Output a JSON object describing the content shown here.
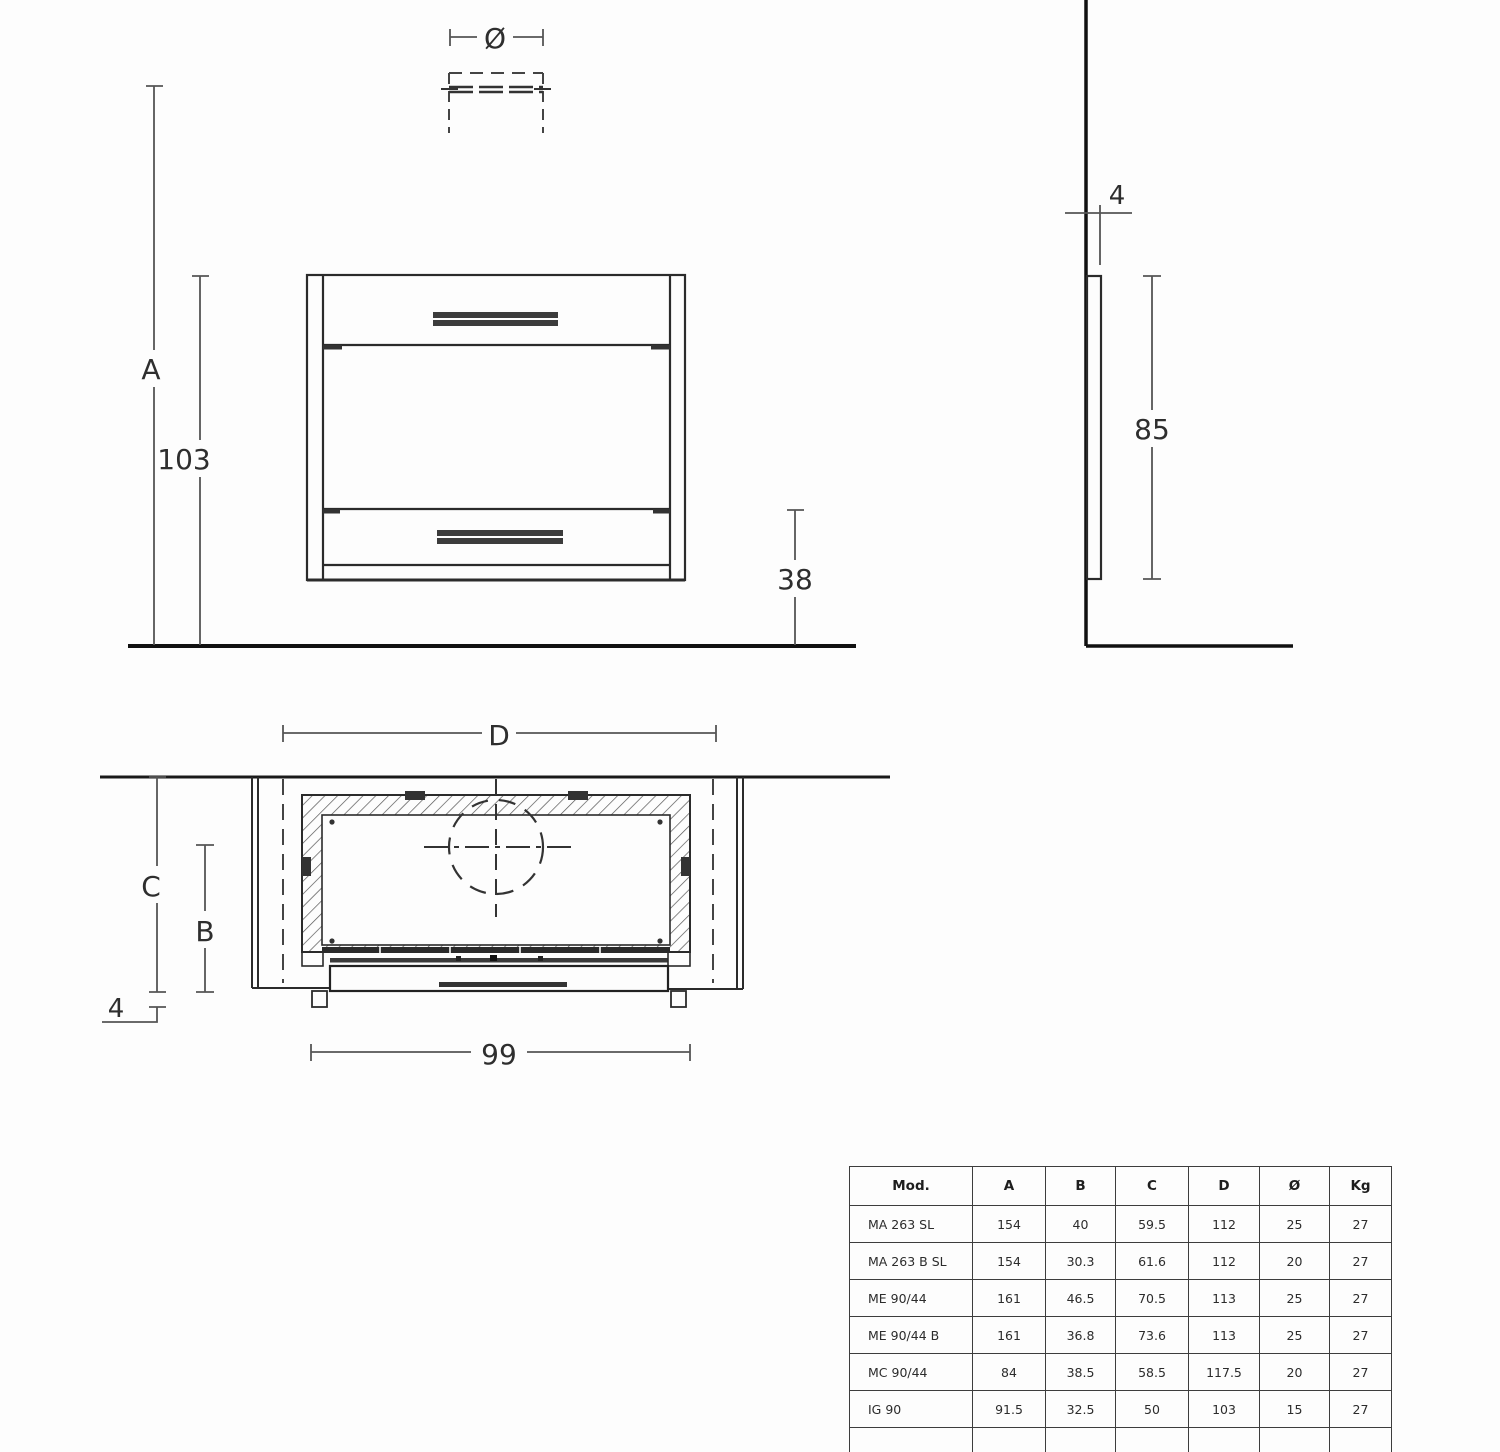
{
  "front_view": {
    "labels": {
      "diameter": "Ø",
      "a": "A",
      "h103": "103",
      "h38": "38"
    }
  },
  "side_view": {
    "labels": {
      "t4": "4",
      "h85": "85"
    }
  },
  "plan_view": {
    "labels": {
      "d": "D",
      "c": "C",
      "b": "B",
      "t4": "4",
      "w99": "99"
    }
  },
  "spec_table": {
    "headers": [
      "Mod.",
      "A",
      "B",
      "C",
      "D",
      "Ø",
      "Kg"
    ],
    "rows": [
      [
        "MA 263 SL",
        "154",
        "40",
        "59.5",
        "112",
        "25",
        "27"
      ],
      [
        "MA 263 B SL",
        "154",
        "30.3",
        "61.6",
        "112",
        "20",
        "27"
      ],
      [
        "ME 90/44",
        "161",
        "46.5",
        "70.5",
        "113",
        "25",
        "27"
      ],
      [
        "ME 90/44 B",
        "161",
        "36.8",
        "73.6",
        "113",
        "25",
        "27"
      ],
      [
        "MC 90/44",
        "84",
        "38.5",
        "58.5",
        "117.5",
        "20",
        "27"
      ],
      [
        "IG 90",
        "91.5",
        "32.5",
        "50",
        "103",
        "15",
        "27"
      ]
    ]
  }
}
